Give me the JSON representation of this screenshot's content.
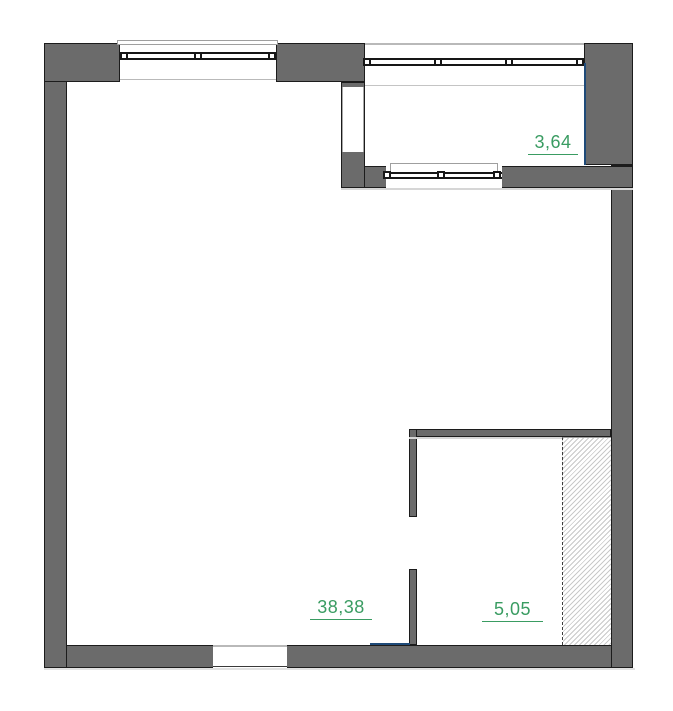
{
  "plan_title": "apartment-floor-plan",
  "colors": {
    "wall": "#6b6b6b",
    "outline": "#1c1c1c",
    "sill": "#9f9f9f",
    "hatch_line": "#c9c9c9",
    "accent_green": "#3a9c62",
    "accent_blue": "#1f4a78"
  },
  "rooms": [
    {
      "name": "main-room",
      "area": "38,38"
    },
    {
      "name": "balcony",
      "area": "3,64"
    },
    {
      "name": "small-room",
      "area": "5,05"
    }
  ]
}
